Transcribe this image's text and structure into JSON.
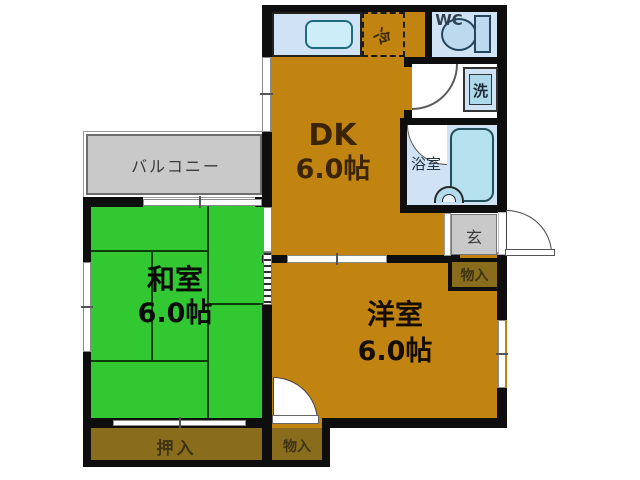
{
  "plan_title": "apartment-floorplan",
  "rooms": {
    "dk": {
      "label": "DK",
      "size": "6.0帖"
    },
    "washitsu": {
      "label": "和室",
      "size": "6.0帖"
    },
    "yoshitsu": {
      "label": "洋室",
      "size": "6.0帖"
    },
    "balcony": {
      "label": "バルコニー"
    },
    "wc": {
      "label": "WC"
    },
    "bathroom": {
      "label": "浴室"
    },
    "washer": {
      "label": "洗"
    },
    "fridge": {
      "label": "冷"
    },
    "entrance": {
      "label": "玄"
    },
    "oshiire": {
      "label": "押入"
    },
    "storage_entrance": {
      "label": "物入"
    },
    "storage_bottom": {
      "label": "物入"
    }
  },
  "colors": {
    "room_orange": "#c28410",
    "tatami_green": "#32c832",
    "closet_olive": "#8a6d1c",
    "gray_area": "#c9c9c9",
    "water_lightblue": "#cfe3f4",
    "fixture_blue": "#b5e0ee",
    "sink_cyan": "#cdeef8",
    "wall_black": "#0e0e0e"
  }
}
